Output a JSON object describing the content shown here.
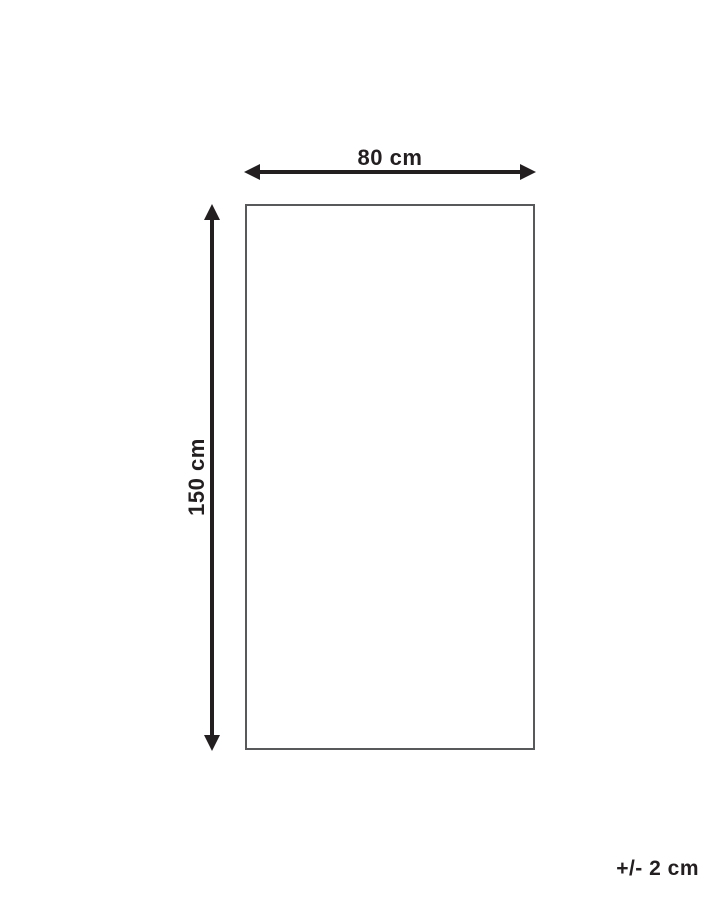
{
  "diagram": {
    "type": "product-dimension-diagram",
    "width_label": "80 cm",
    "height_label": "150 cm",
    "tolerance_label": "+/- 2 cm",
    "colors": {
      "arrow_line": "#231f20",
      "text": "#231f20",
      "rect_outline": "#58595b",
      "background": "#ffffff"
    }
  }
}
